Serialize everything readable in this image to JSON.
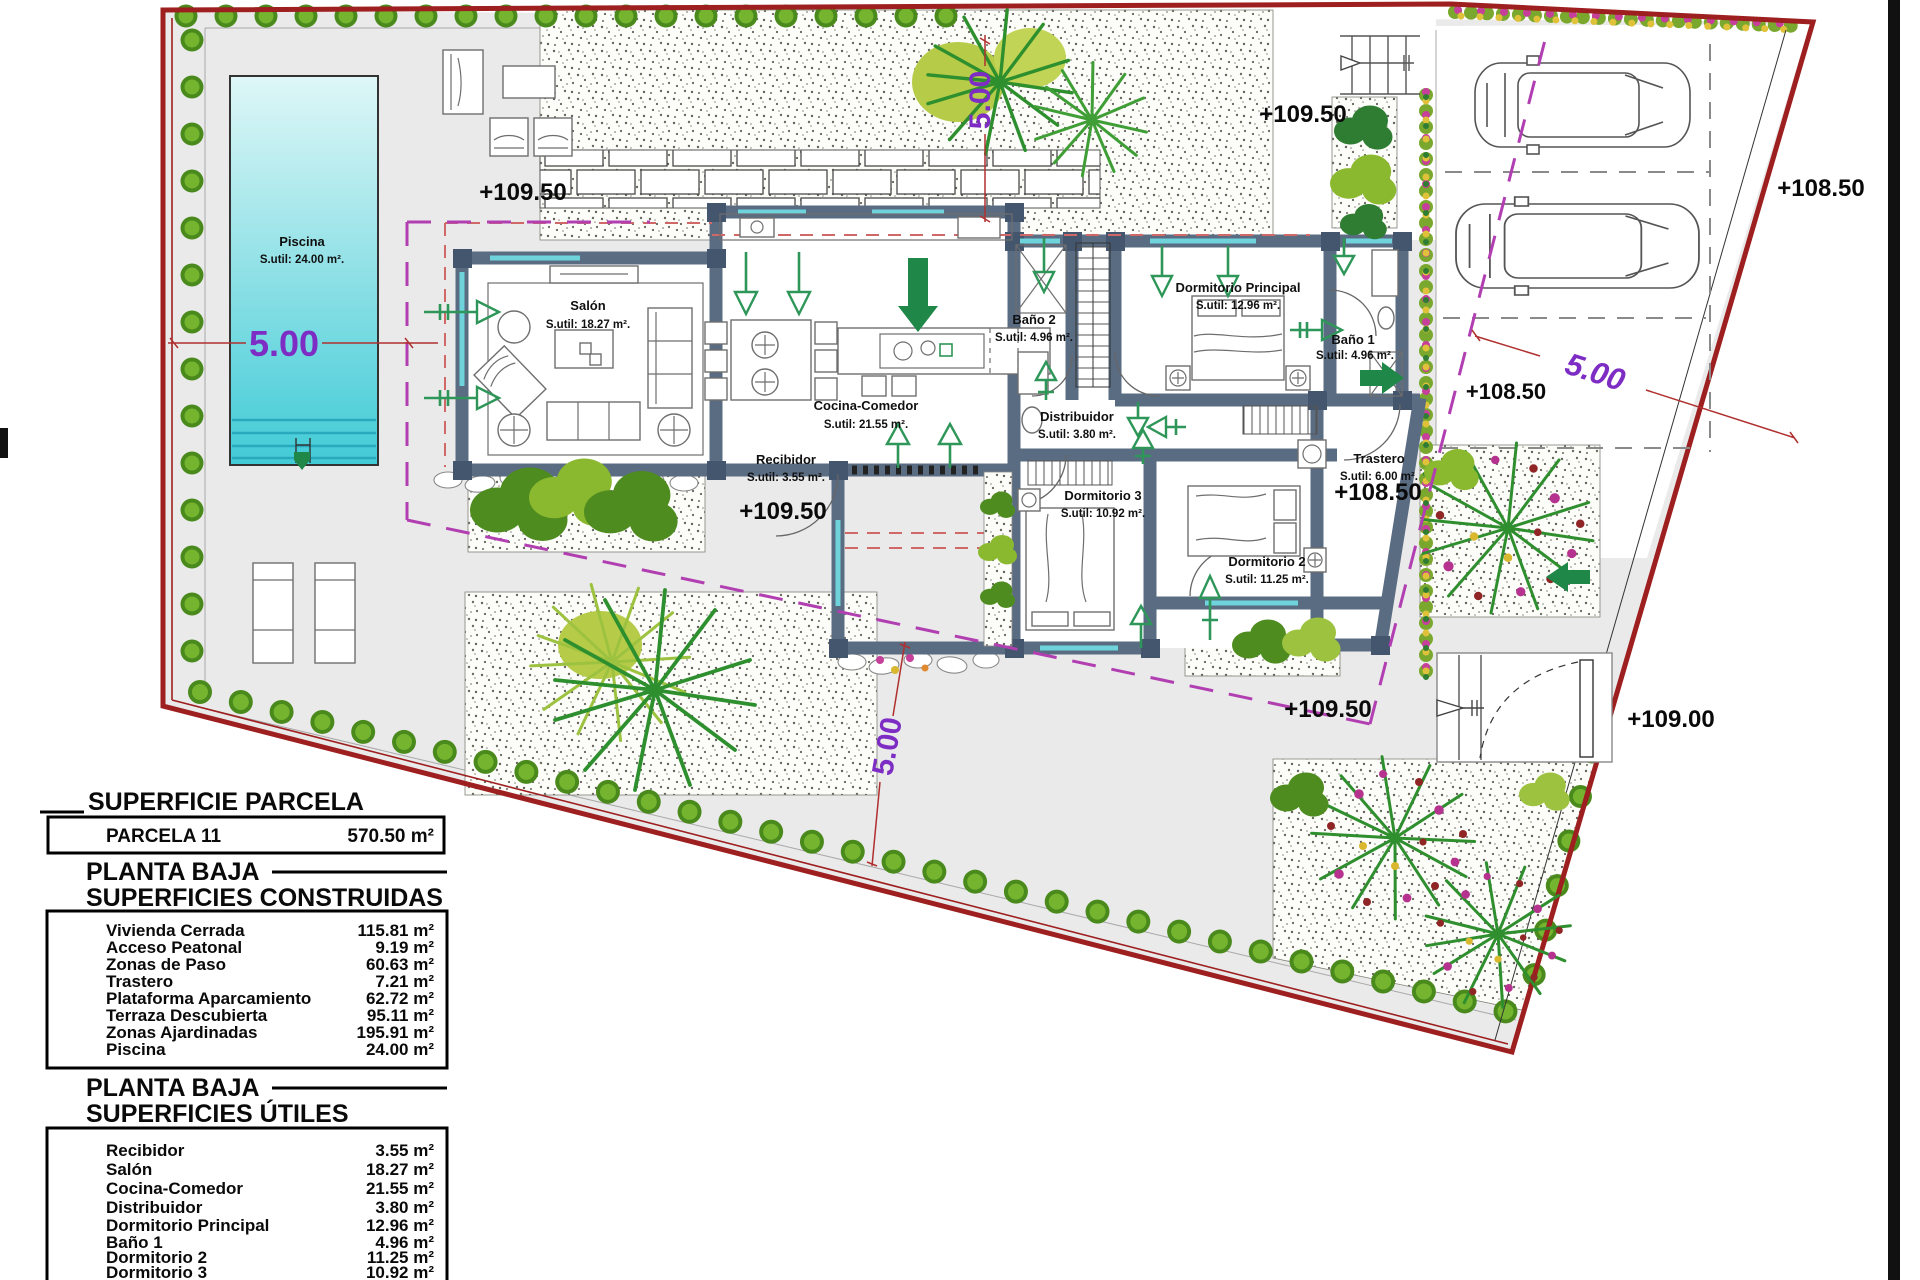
{
  "plan_type": "site-floor-plan",
  "rooms": [
    {
      "name": "Salón",
      "area": "S.util: 18.27 m²."
    },
    {
      "name": "Cocina-Comedor",
      "area": "S.util: 21.55 m²."
    },
    {
      "name": "Recibidor",
      "area": "S.util: 3.55 m²."
    },
    {
      "name": "Baño 2",
      "area": "S.util: 4.96 m²."
    },
    {
      "name": "Dormitorio Principal",
      "area": "S.util: 12.96 m²."
    },
    {
      "name": "Baño 1",
      "area": "S.util: 4.96 m²."
    },
    {
      "name": "Distribuidor",
      "area": "S.util: 3.80 m²."
    },
    {
      "name": "Dormitorio 3",
      "area": "S.util: 10.92 m²."
    },
    {
      "name": "Dormitorio 2",
      "area": "S.util: 11.25 m²."
    },
    {
      "name": "Trastero",
      "area": "S.util: 6.00 m²."
    },
    {
      "name": "Piscina",
      "area": "S.util: 24.00 m²."
    }
  ],
  "elevations": [
    "+109.50",
    "+109.50",
    "+108.50",
    "+108.50",
    "+108.50",
    "+109.50",
    "+109.50",
    "+109.00"
  ],
  "dims": [
    "5.00",
    "5.00",
    "5.00",
    "5.00"
  ],
  "tables": {
    "parcela": {
      "title": "SUPERFICIE PARCELA",
      "row_label": "PARCELA 11",
      "row_value": "570.50 m²"
    },
    "construidas": {
      "title1": "PLANTA BAJA",
      "title2": "SUPERFICIES CONSTRUIDAS",
      "rows": [
        {
          "label": "Vivienda Cerrada",
          "value": "115.81 m²"
        },
        {
          "label": "Acceso Peatonal",
          "value": "9.19 m²"
        },
        {
          "label": "Zonas de Paso",
          "value": "60.63 m²"
        },
        {
          "label": "Trastero",
          "value": "7.21 m²"
        },
        {
          "label": "Plataforma Aparcamiento",
          "value": "62.72 m²"
        },
        {
          "label": "Terraza Descubierta",
          "value": "95.11 m²"
        },
        {
          "label": "Zonas Ajardinadas",
          "value": "195.91 m²"
        },
        {
          "label": "Piscina",
          "value": "24.00 m²"
        }
      ]
    },
    "utiles": {
      "title1": "PLANTA BAJA",
      "title2": "SUPERFICIES ÚTILES",
      "rows": [
        {
          "label": "Recibidor",
          "value": "3.55 m²"
        },
        {
          "label": "Salón",
          "value": "18.27 m²"
        },
        {
          "label": "Cocina-Comedor",
          "value": "21.55 m²"
        },
        {
          "label": "Distribuidor",
          "value": "3.80 m²"
        },
        {
          "label": "Dormitorio Principal",
          "value": "12.96 m²"
        },
        {
          "label": "Baño 1",
          "value": "4.96 m²"
        },
        {
          "label": "Dormitorio 2",
          "value": "11.25 m²"
        },
        {
          "label": "Dormitorio 3",
          "value": "10.92 m²"
        },
        {
          "label": "Baño 2",
          "value": "4.96 m²"
        }
      ]
    }
  },
  "colors": {
    "boundary": "#9e1f1f",
    "setback_line": "#b13fb1",
    "dimension_text": "#7d2cc4",
    "wall": "#5a6c82",
    "pool_top": "#dff7f7",
    "pool_bottom": "#41cbd6",
    "arrow_green": "#2e9658",
    "hedge_green": "#4e8c1f",
    "flower_magenta": "#c53f9b"
  }
}
